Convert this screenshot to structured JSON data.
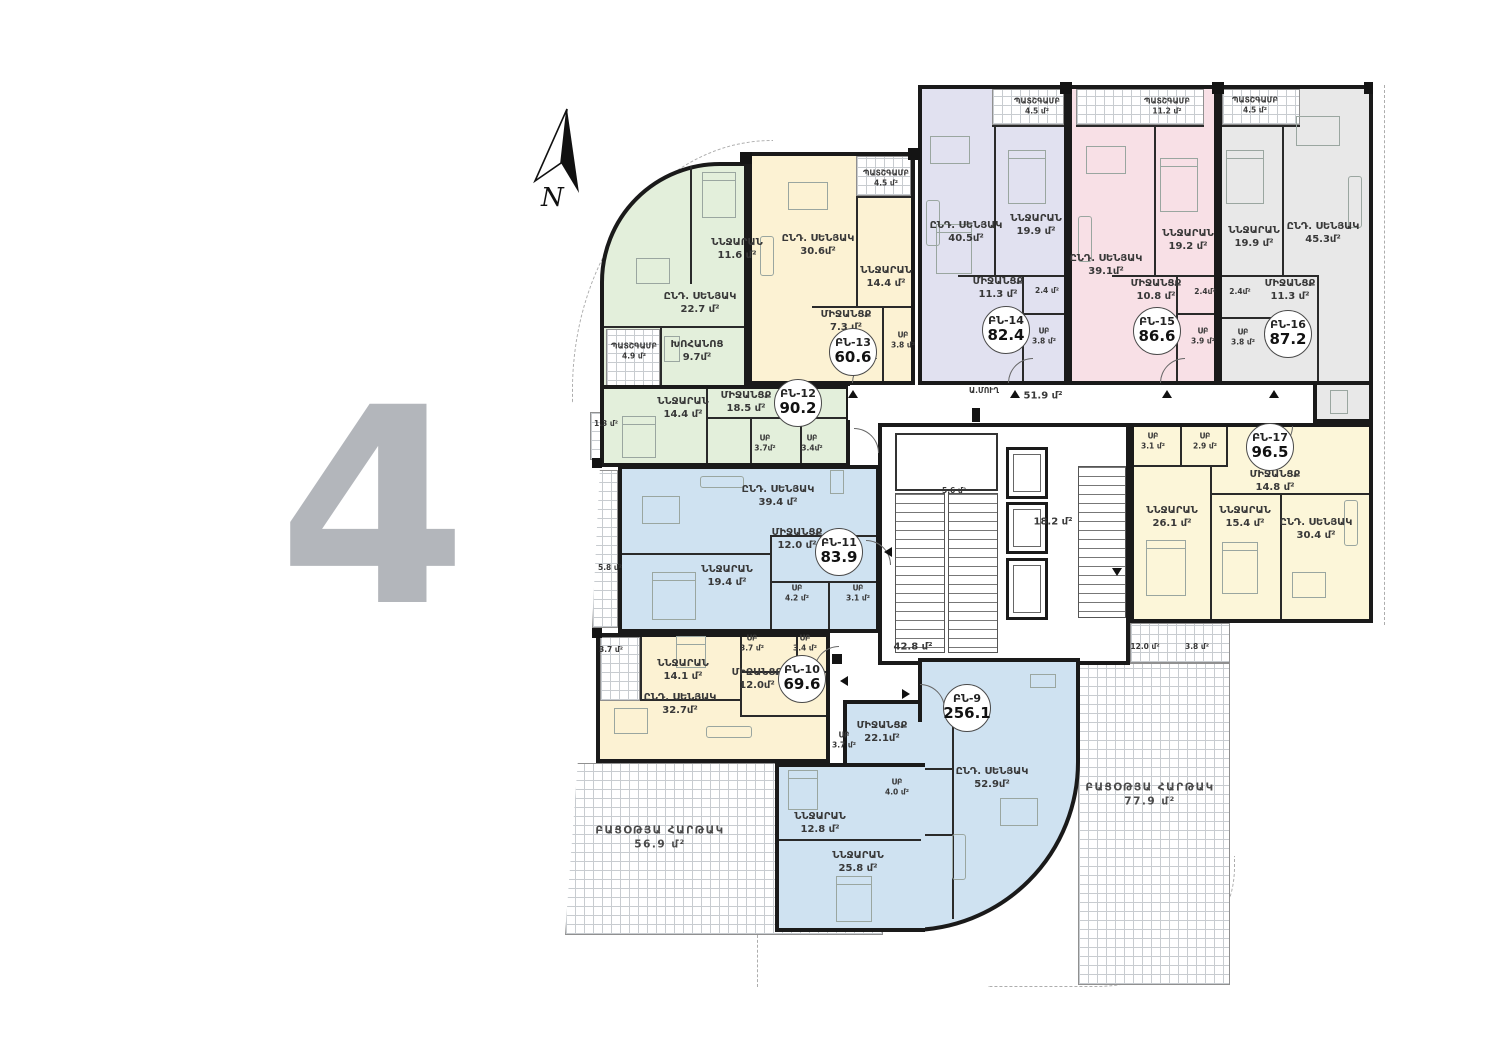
{
  "floor_plan": {
    "floor_number": "4",
    "compass_label": "N",
    "apartments": [
      {
        "id": "ԲՆ-9",
        "total_area": "256.1",
        "color": "#cfe2f1",
        "rooms": [
          {
            "name": "ՄԻՋԱՆՑՔ",
            "area": "22.1մ²"
          },
          {
            "name": "ՍԲ",
            "area": "3.7 մ²"
          },
          {
            "name": "ՍԲ",
            "area": "4.0 մ²"
          },
          {
            "name": "ՆՆՋԱՐԱՆ",
            "area": "12.8 մ²"
          },
          {
            "name": "ՆՆՋԱՐԱՆ",
            "area": "25.8 մ²"
          },
          {
            "name": "ԸՆԴ. ՍԵՆՅԱԿ",
            "area": "52.9մ²"
          }
        ]
      },
      {
        "id": "ԲՆ-10",
        "total_area": "69.6",
        "color": "#fcf2d3",
        "rooms": [
          {
            "name": "ՆՆՋԱՐԱՆ",
            "area": "14.1 մ²"
          },
          {
            "name": "ՍԲ",
            "area": "3.7 մ²"
          },
          {
            "name": "ՍԲ",
            "area": "3.4 մ²"
          },
          {
            "name": "ՄԻՋԱՆՑՔ",
            "area": "12.0մ²"
          },
          {
            "name": "ԸՆԴ. ՍԵՆՅԱԿ",
            "area": "32.7մ²"
          },
          {
            "name": "",
            "area": "3.7 մ²"
          }
        ]
      },
      {
        "id": "ԲՆ-11",
        "total_area": "83.9",
        "color": "#cfe2f1",
        "rooms": [
          {
            "name": "ԸՆԴ. ՍԵՆՅԱԿ",
            "area": "39.4 մ²"
          },
          {
            "name": "ՄԻՋԱՆՑՔ",
            "area": "12.0 մ²"
          },
          {
            "name": "ՆՆՋԱՐԱՆ",
            "area": "19.4 մ²"
          },
          {
            "name": "ՍԲ",
            "area": "4.2 մ²"
          },
          {
            "name": "ՍԲ",
            "area": "3.1 մ²"
          },
          {
            "name": "",
            "area": "5.8 մ²"
          }
        ]
      },
      {
        "id": "ԲՆ-12",
        "total_area": "90.2",
        "color": "#e3efdb",
        "rooms": [
          {
            "name": "ԸՆԴ. ՍԵՆՅԱԿ",
            "area": "22.7 մ²"
          },
          {
            "name": "ՆՆՋԱՐԱՆ",
            "area": "11.6 մ²"
          },
          {
            "name": "ՊԱՏՇԳԱՄԲ",
            "area": "4.9 մ²"
          },
          {
            "name": "ԽՈՀԱՆՈՑ",
            "area": "9.7մ²"
          },
          {
            "name": "ՆՆՋԱՐԱՆ",
            "area": "14.4 մ²"
          },
          {
            "name": "ՄԻՋԱՆՑՔ",
            "area": "18.5 մ²"
          },
          {
            "name": "ՍԲ",
            "area": "3.7մ²"
          },
          {
            "name": "ՍԲ",
            "area": "3.4մ²"
          },
          {
            "name": "",
            "area": "1.3 մ²"
          }
        ]
      },
      {
        "id": "ԲՆ-13",
        "total_area": "60.6",
        "color": "#fcf2d3",
        "rooms": [
          {
            "name": "ԸՆԴ. ՍԵՆՅԱԿ",
            "area": "30.6մ²"
          },
          {
            "name": "ՆՆՋԱՐԱՆ",
            "area": "14.4 մ²"
          },
          {
            "name": "ՄԻՋԱՆՑՔ",
            "area": "7.3 մ²"
          },
          {
            "name": "ՍԲ",
            "area": "3.8 մ²"
          },
          {
            "name": "ՊԱՏՇԳԱՄԲ",
            "area": "4.5 մ²"
          }
        ]
      },
      {
        "id": "ԲՆ-14",
        "total_area": "82.4",
        "color": "#e1e1f0",
        "rooms": [
          {
            "name": "ԸՆԴ. ՍԵՆՅԱԿ",
            "area": "40.5մ²"
          },
          {
            "name": "ՆՆՋԱՐԱՆ",
            "area": "19.9 մ²"
          },
          {
            "name": "ՄԻՋԱՆՑՔ",
            "area": "11.3 մ²"
          },
          {
            "name": "",
            "area": "2.4 մ²"
          },
          {
            "name": "ՍԲ",
            "area": "3.8 մ²"
          },
          {
            "name": "ՊԱՏՇԳԱՄԲ",
            "area": "4.5 մ²"
          }
        ]
      },
      {
        "id": "ԲՆ-15",
        "total_area": "86.6",
        "color": "#f8e0e6",
        "rooms": [
          {
            "name": "ԸՆԴ. ՍԵՆՅԱԿ",
            "area": "39.1մ²"
          },
          {
            "name": "ՆՆՋԱՐԱՆ",
            "area": "19.2 մ²"
          },
          {
            "name": "ՄԻՋԱՆՑՔ",
            "area": "10.8 մ²"
          },
          {
            "name": "",
            "area": "2.4մ²"
          },
          {
            "name": "ՍԲ",
            "area": "3.9 մ²"
          },
          {
            "name": "ՊԱՏՇԳԱՄԲ",
            "area": "11.2 մ²"
          }
        ]
      },
      {
        "id": "ԲՆ-16",
        "total_area": "87.2",
        "color": "#e8e8e8",
        "rooms": [
          {
            "name": "ԸՆԴ. ՍԵՆՅԱԿ",
            "area": "45.3մ²"
          },
          {
            "name": "ՆՆՋԱՐԱՆ",
            "area": "19.9 մ²"
          },
          {
            "name": "ՄԻՋԱՆՑՔ",
            "area": "11.3 մ²"
          },
          {
            "name": "",
            "area": "2.4մ²"
          },
          {
            "name": "ՍԲ",
            "area": "3.8 մ²"
          },
          {
            "name": "ՊԱՏՇԳԱՄԲ",
            "area": "4.5 մ²"
          }
        ]
      },
      {
        "id": "ԲՆ-17",
        "total_area": "96.5",
        "color": "#fcf6d9",
        "rooms": [
          {
            "name": "ՍԲ",
            "area": "3.1 մ²"
          },
          {
            "name": "ՍԲ",
            "area": "2.9 մ²"
          },
          {
            "name": "ՄԻՋԱՆՑՔ",
            "area": "14.8 մ²"
          },
          {
            "name": "ՆՆՋԱՐԱՆ",
            "area": "26.1 մ²"
          },
          {
            "name": "ՆՆՋԱՐԱՆ",
            "area": "15.4 մ²"
          },
          {
            "name": "ԸՆԴ. ՍԵՆՅԱԿ",
            "area": "30.4 մ²"
          }
        ]
      }
    ],
    "common_areas": {
      "corridor_upper": "51.9 մ²",
      "corridor_lower": "42.8 մ²",
      "stairwell": "5.6 մ²",
      "elevator_lobby": "18.2 մ²",
      "garbage_chute": "Ա.ՄՈՒՂ",
      "terrace_strip_left": "12.0 մ²",
      "terrace_strip_right": "3.8 մ²"
    },
    "terraces": [
      {
        "name": "ԲԱՑՕԹՅԱ ՀԱՐԹԱԿ",
        "area": "56.9 մ²"
      },
      {
        "name": "ԲԱՑՕԹՅԱ ՀԱՐԹԱԿ",
        "area": "77.9 մ²"
      }
    ]
  }
}
